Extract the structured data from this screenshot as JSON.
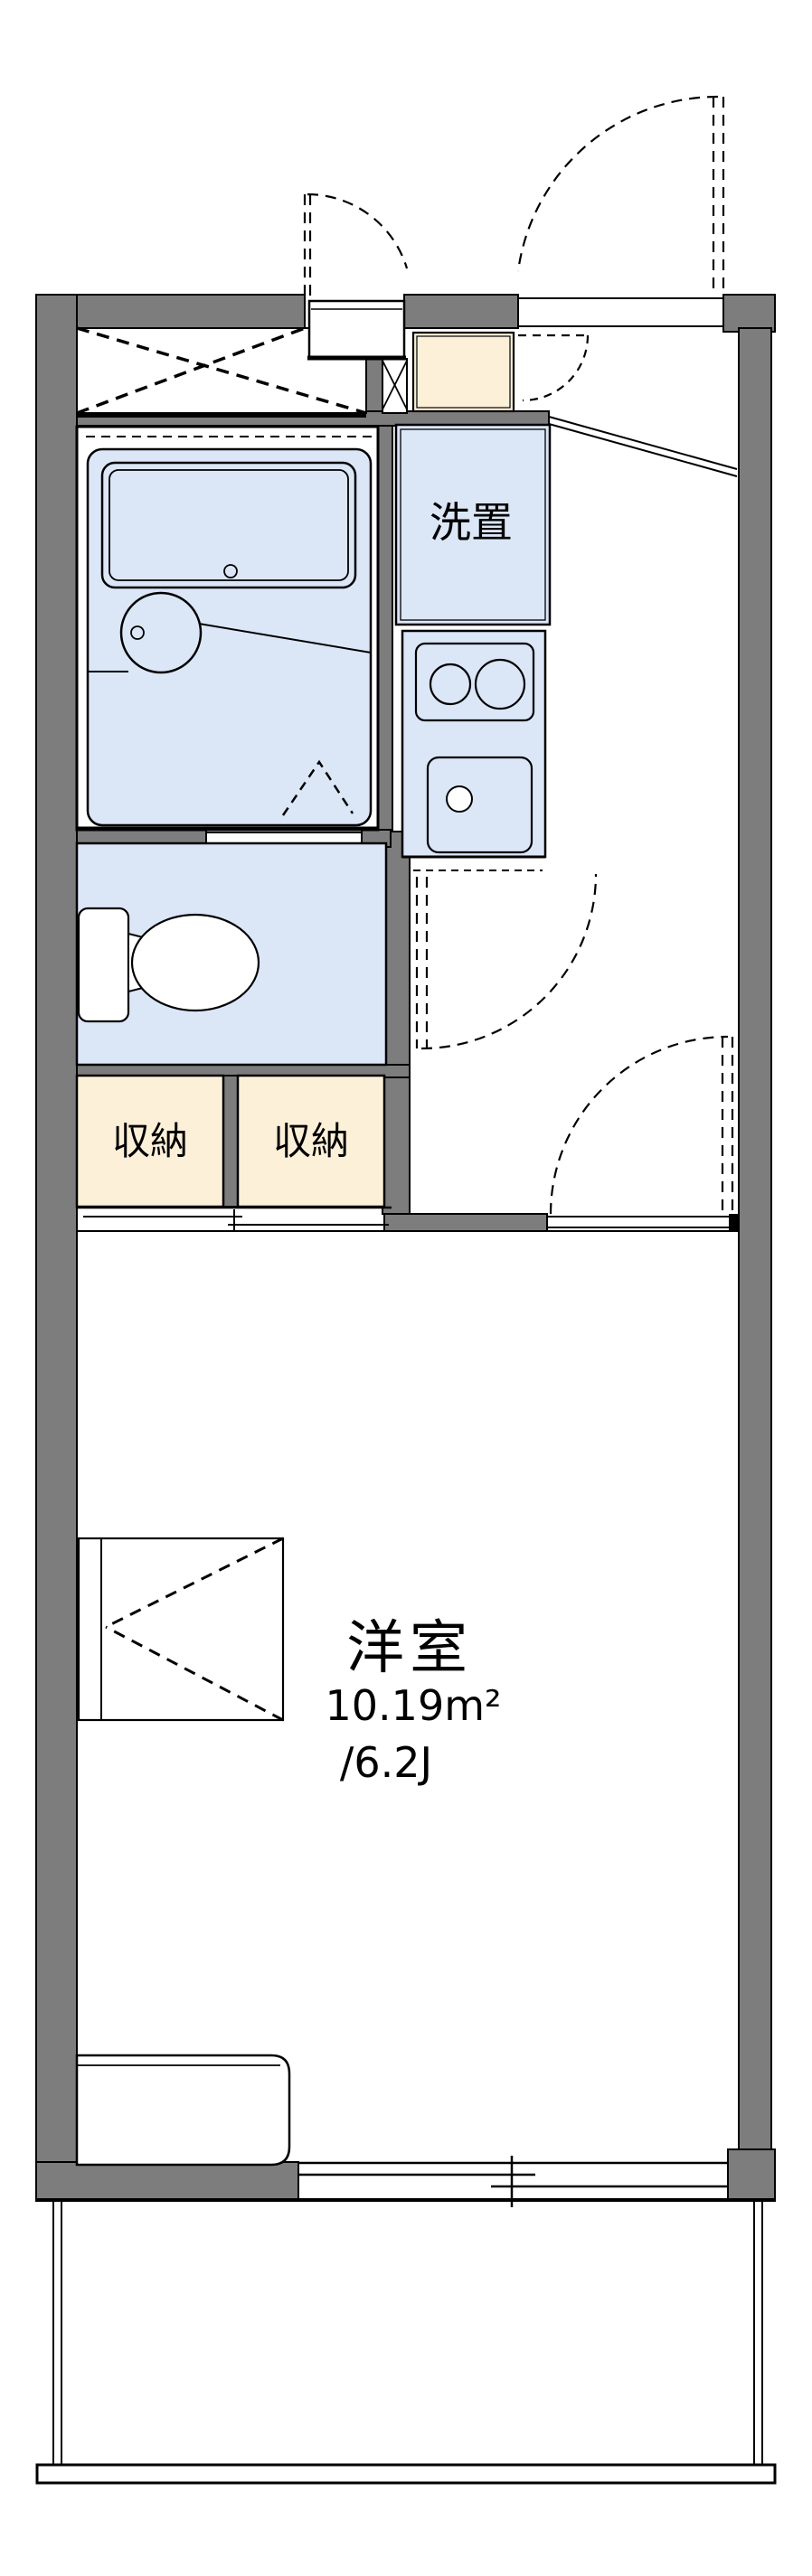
{
  "floor_plan": {
    "labels": {
      "laundry": "洗置",
      "storage_left": "収納",
      "storage_right": "収納"
    },
    "main_room": {
      "name": "洋室",
      "area_m2": "10.19m²",
      "area_tatami": "/6.2J"
    },
    "colors": {
      "wall": "#7d7d7d",
      "wet_area_fill": "#dbe6f7",
      "storage_fill": "#fcf0d8",
      "line": "#000000",
      "background": "#ffffff"
    }
  }
}
